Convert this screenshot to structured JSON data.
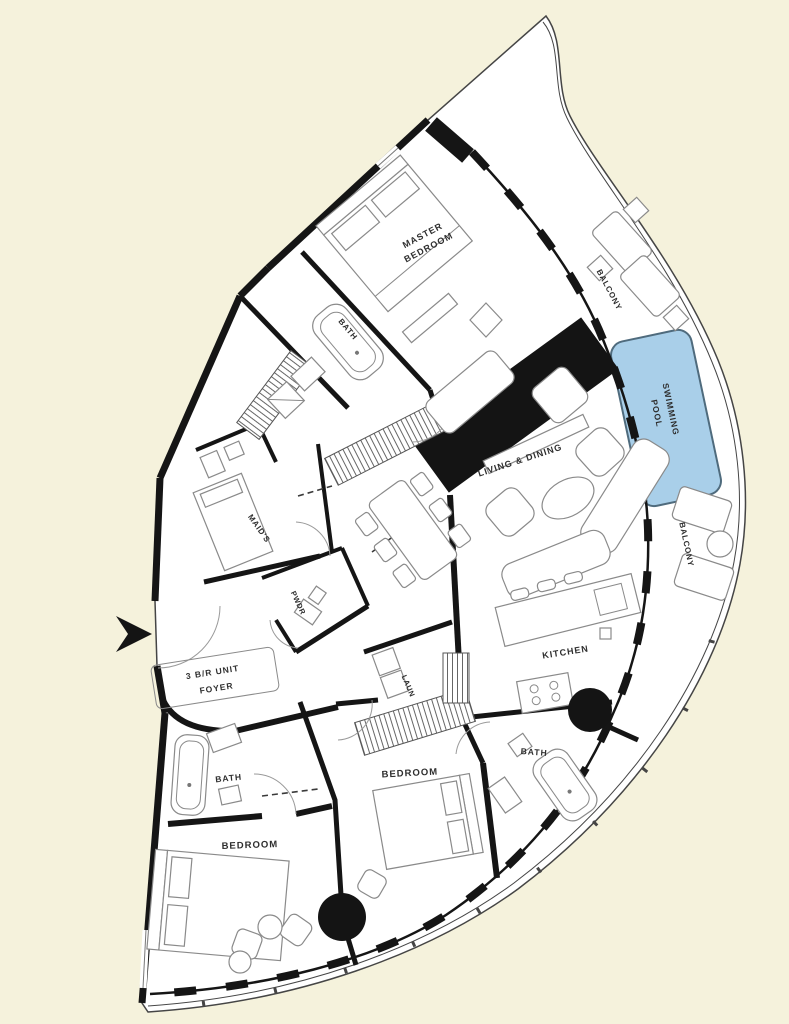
{
  "colors": {
    "background": "#f5f2dc",
    "plan_fill": "#ffffff",
    "wall": "#151515",
    "pool_fill": "#a9cfe9",
    "label_text": "#2e2e2e"
  },
  "rooms": {
    "master_bedroom_line1": "MASTER",
    "master_bedroom_line2": "BEDROOM",
    "master_bath": "BATH",
    "maids_room": "MAID'S",
    "powder_room": "PWDR",
    "unit_type": "3 B/R UNIT",
    "foyer": "FOYER",
    "living_dining": "LIVING & DINING",
    "kitchen": "KITCHEN",
    "laundry": "LAUN",
    "bath_2": "BATH",
    "bedroom_2": "BEDROOM",
    "bedroom_3": "BEDROOM",
    "bath_3": "BATH",
    "swimming_pool_line1": "SWIMMING",
    "swimming_pool_line2": "POOL",
    "balcony_upper": "BALCONY",
    "balcony_lower": "BALCONY"
  }
}
